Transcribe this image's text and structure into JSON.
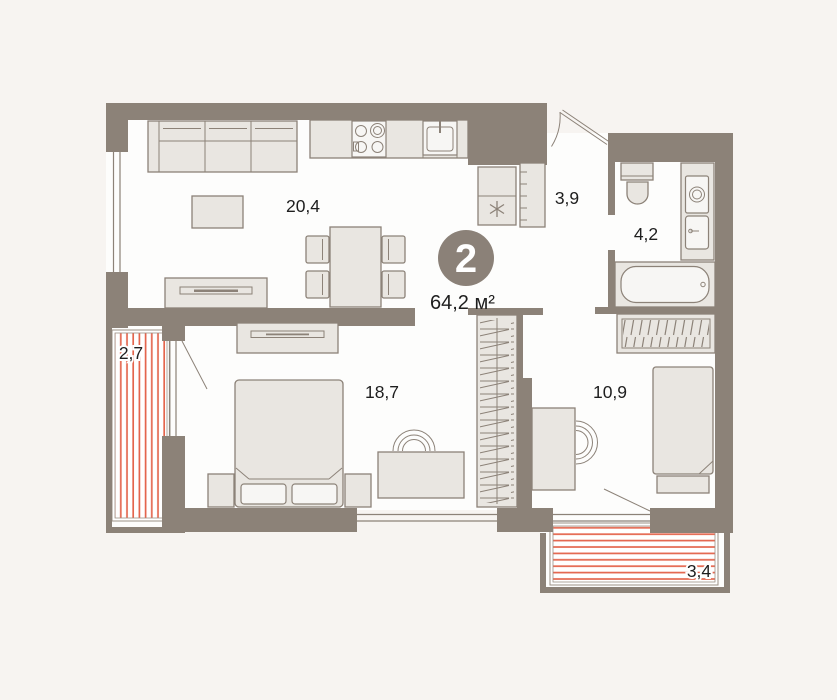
{
  "plan": {
    "badge": {
      "room_count": "2",
      "total_area": "64,2 м²"
    },
    "room_labels": {
      "living_kitchen": "20,4",
      "hallway": "3,9",
      "bathroom": "4,2",
      "balcony_left": "2,7",
      "bedroom": "18,7",
      "bedroom2": "10,9",
      "balcony_bottom": "3,4"
    },
    "icons": {
      "freezer_icon": "snowflake-asterisk",
      "stove_icon": "four-burner-hob",
      "sink_icon": "kitchen-sink",
      "toilet_icon": "toilet",
      "washing_machine_icon": "washing-machine",
      "bathtub_icon": "bathtub",
      "hanger_rail_icon": "wardrobe-hangers"
    },
    "colors": {
      "wall": "#8c8278",
      "furniture_fill": "#e9e6e1",
      "balcony_hatch": "#e4654d",
      "badge_fill": "#8b8178",
      "floor": "#fdfdfc",
      "background": "#f7f4f1",
      "text": "#1e1e1e"
    }
  }
}
